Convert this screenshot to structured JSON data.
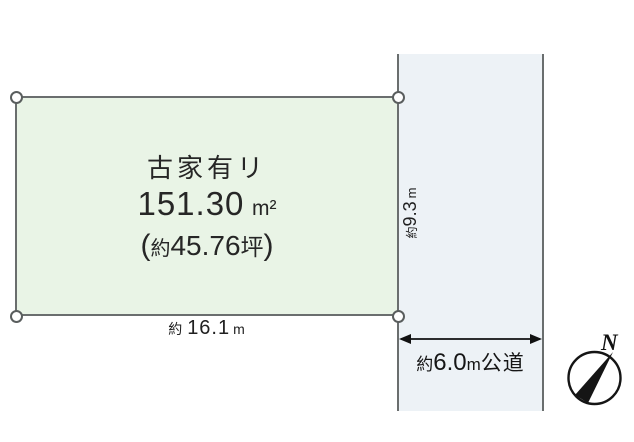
{
  "colors": {
    "plot_fill": "#e9f4e6",
    "road_fill": "#edf2f6",
    "line": "#6a6e6e",
    "ink": "#1c1c1c"
  },
  "plot": {
    "building_note": "古家有リ",
    "area": {
      "value": "151.30",
      "unit": "m²"
    },
    "area_tsubo": {
      "open": "(",
      "approx": "約",
      "value": "45.76",
      "unit": "坪",
      "close": ")"
    },
    "frontage": {
      "approx": "約",
      "value": "16.1",
      "unit": "m"
    },
    "depth": {
      "approx": "約",
      "value": "9.3",
      "unit": "m"
    }
  },
  "road": {
    "label": {
      "approx": "約",
      "value": "6.0",
      "unit": "m",
      "type": "公道"
    }
  },
  "compass": {
    "north": "N"
  }
}
